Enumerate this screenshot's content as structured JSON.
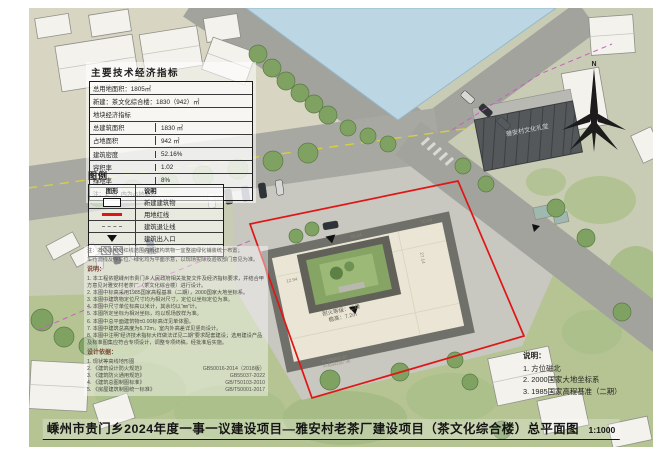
{
  "sheet": {
    "title": "嵊州市贵门乡2024年度一事一议建设项目—雅安村老茶厂建设项目（茶文化综合楼）总平面图",
    "scale": "1:1000"
  },
  "indicators": {
    "title": "主要技术经济指标",
    "row_total_land": "总用地面积：1805㎡",
    "row_new": "新建：茶文化综合楼：1830（942）㎡",
    "subheader": "地块经济指标",
    "rows": [
      {
        "label": "总建筑面积",
        "value": "1830 ㎡"
      },
      {
        "label": "占地面积",
        "value": "942 ㎡"
      },
      {
        "label": "建筑密度",
        "value": "52.16%"
      },
      {
        "label": "容积率",
        "value": "1.02"
      },
      {
        "label": "绿地率",
        "value": "8%"
      }
    ],
    "note": "注：1.（）内为占地面积"
  },
  "legend": {
    "title": "图例",
    "col_symbol": "图形",
    "col_desc": "说明",
    "items": [
      {
        "label": "新建建筑物"
      },
      {
        "label": "用地红线"
      },
      {
        "label": "建筑退让线"
      },
      {
        "label": "建筑出入口"
      },
      {
        "label": "绿化"
      }
    ]
  },
  "notes_left": {
    "prenote1": "注：本项目用地红线范围内新建构筑物一宜整遍绿化铺装统一布置；",
    "prenote2": "车行流线及停车位、绿化均为平面示意，以现场实际及验收部门意见为准。",
    "heading": "说明：",
    "items": [
      "1. 本工程依据嵊州市贵门乡人民政府相关批复文件及经济指标要求，并结合甲方意见对雅安村老茶厂（茶文化综合楼）进行设计。",
      "2. 本图中标高采用1985国家高程基准（二期），2000国家大地坐标系。",
      "3. 本图中建筑物定位尺寸均为相对尺寸，定位以坐标定位为准。",
      "4. 本图中尺寸单位标高以米计，其余均以“㎜”计。",
      "5. 本图所定坐标为相对坐标，均以现场放样为准。",
      "6. 本图中总平面建筑物±0.00标高详见单体图。",
      "7. 本图中建筑总高度为6.72m，室内外高差详见竖向设计。",
      "8. 本图中注明“经济技术指标大样做法详见二期”要求配套建设；选用建设产品及标准图集应符合专项设计，调整专项终稿，经批准后实施。"
    ],
    "basis_heading": "设计依据：",
    "basis": [
      {
        "name": "1. 现状等高线地形图",
        "code": ""
      },
      {
        "name": "2. 《建筑设计防火规范》",
        "code": "GB50016-2014（2018版）"
      },
      {
        "name": "3. 《建筑防火通用规范》",
        "code": "GB55037-2022"
      },
      {
        "name": "4. 《建筑总图制图标准》",
        "code": "GB/T50103-2010"
      },
      {
        "name": "5. 《房屋建筑制图统一标准》",
        "code": "GB/T50001-2017"
      }
    ]
  },
  "notes_right": {
    "heading": "说明：",
    "items": [
      "1. 方位磁北",
      "2. 2000国家大地坐标系",
      "3. 1985国家高程基准（二期）"
    ]
  },
  "plan": {
    "building_label1": "茶文化综合楼",
    "building_label2": "耐火等级：二级",
    "building_label3": "檐高：7.2m",
    "hall_label": "雅安村文化礼堂",
    "north_label": "N",
    "dim_top": "30.24",
    "dim_right": "10.44",
    "dim_left": "12.94",
    "dim_side": "27.14",
    "coord_x": "X=3255031.87",
    "coord_y": "Y=40443357.46",
    "colors": {
      "red_line": "#e01616",
      "water": "#bdd6e4",
      "road": "#a3a39e",
      "green": "#b6c494",
      "roof": "#eae5d4",
      "eave": "#70706a"
    }
  }
}
